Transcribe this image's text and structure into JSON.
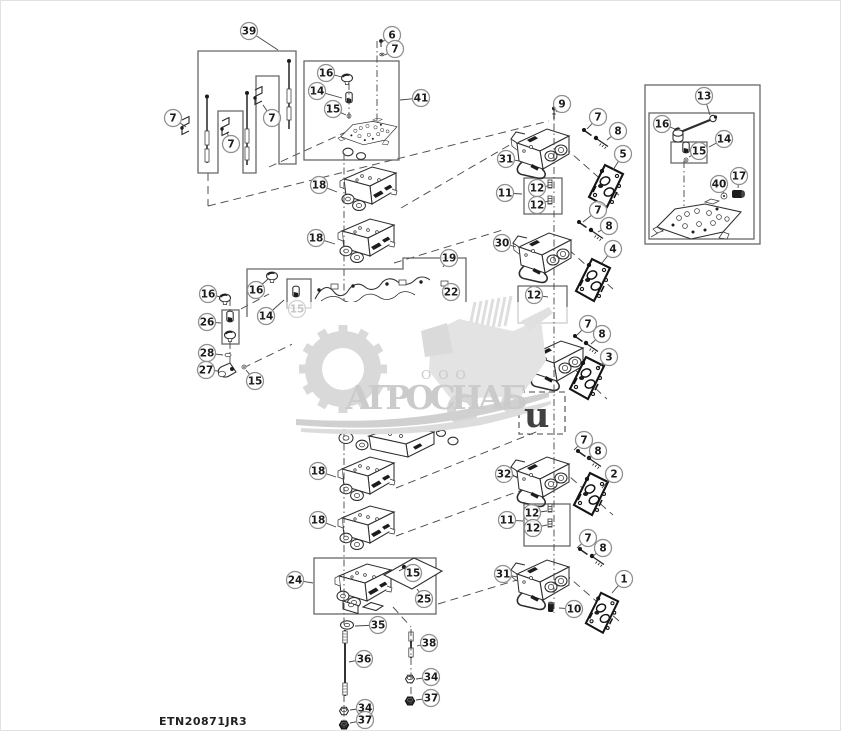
{
  "meta": {
    "footer_code": "ETN20871JR3"
  },
  "watermark": {
    "org": "ООО",
    "name": "АГРОСНАБ",
    "stray_letter": "u"
  },
  "colors": {
    "line": "#2d2d2d",
    "frame_box": "#686868",
    "dashed_line": "#4d4d4d",
    "balloon_stroke": "#8f8f8f",
    "balloon_text": "#1b1b1b",
    "watermark_gray": "#d6d6d6",
    "gasket_ink": "#141414"
  },
  "callouts": [
    {
      "n": "39",
      "x": 248,
      "y": 30,
      "lx": 277,
      "ly": 49
    },
    {
      "n": "7",
      "x": 172,
      "y": 117,
      "lx": 185,
      "ly": 126
    },
    {
      "n": "7",
      "x": 230,
      "y": 143,
      "lx": 226,
      "ly": 131
    },
    {
      "n": "7",
      "x": 271,
      "y": 117,
      "lx": 262,
      "ly": 104
    },
    {
      "n": "6",
      "x": 391,
      "y": 34,
      "lx": 381,
      "ly": 41
    },
    {
      "n": "7",
      "x": 394,
      "y": 48,
      "lx": 384,
      "ly": 54
    },
    {
      "n": "16",
      "x": 325,
      "y": 72,
      "lx": 341,
      "ly": 76
    },
    {
      "n": "14",
      "x": 316,
      "y": 90,
      "lx": 341,
      "ly": 97
    },
    {
      "n": "15",
      "x": 332,
      "y": 108,
      "lx": 345,
      "ly": 114
    },
    {
      "n": "41",
      "x": 420,
      "y": 97,
      "lx": 399,
      "ly": 99
    },
    {
      "n": "18",
      "x": 318,
      "y": 184,
      "lx": 336,
      "ly": 191
    },
    {
      "n": "18",
      "x": 315,
      "y": 237,
      "lx": 334,
      "ly": 243
    },
    {
      "n": "13",
      "x": 703,
      "y": 95,
      "lx": 709,
      "ly": 114
    },
    {
      "n": "16",
      "x": 661,
      "y": 123,
      "lx": 674,
      "ly": 128
    },
    {
      "n": "14",
      "x": 723,
      "y": 138,
      "lx": 708,
      "ly": 146
    },
    {
      "n": "15",
      "x": 698,
      "y": 150,
      "lx": 688,
      "ly": 156
    },
    {
      "n": "40",
      "x": 718,
      "y": 183,
      "lx": 723,
      "ly": 192
    },
    {
      "n": "17",
      "x": 738,
      "y": 175,
      "lx": 737,
      "ly": 187
    },
    {
      "n": "9",
      "x": 561,
      "y": 103,
      "lx": 555,
      "ly": 111
    },
    {
      "n": "7",
      "x": 597,
      "y": 116,
      "lx": 586,
      "ly": 128
    },
    {
      "n": "8",
      "x": 617,
      "y": 130,
      "lx": 606,
      "ly": 139
    },
    {
      "n": "31",
      "x": 505,
      "y": 158,
      "lx": 519,
      "ly": 160
    },
    {
      "n": "5",
      "x": 622,
      "y": 153,
      "lx": 612,
      "ly": 169
    },
    {
      "n": "11",
      "x": 504,
      "y": 192,
      "lx": 521,
      "ly": 193
    },
    {
      "n": "12",
      "x": 536,
      "y": 187,
      "lx": 547,
      "ly": 185
    },
    {
      "n": "12",
      "x": 536,
      "y": 204,
      "lx": 547,
      "ly": 200
    },
    {
      "n": "7",
      "x": 597,
      "y": 209,
      "lx": 582,
      "ly": 221
    },
    {
      "n": "8",
      "x": 608,
      "y": 225,
      "lx": 597,
      "ly": 231
    },
    {
      "n": "30",
      "x": 501,
      "y": 242,
      "lx": 515,
      "ly": 246
    },
    {
      "n": "4",
      "x": 612,
      "y": 248,
      "lx": 601,
      "ly": 262
    },
    {
      "n": "12",
      "x": 533,
      "y": 294,
      "lx": 547,
      "ly": 296
    },
    {
      "n": "7",
      "x": 587,
      "y": 323,
      "lx": 576,
      "ly": 334
    },
    {
      "n": "8",
      "x": 601,
      "y": 333,
      "lx": 590,
      "ly": 343
    },
    {
      "n": "3",
      "x": 608,
      "y": 356,
      "lx": 597,
      "ly": 367
    },
    {
      "n": "7",
      "x": 583,
      "y": 439,
      "lx": 573,
      "ly": 449
    },
    {
      "n": "8",
      "x": 597,
      "y": 450,
      "lx": 587,
      "ly": 458
    },
    {
      "n": "32",
      "x": 503,
      "y": 473,
      "lx": 517,
      "ly": 476
    },
    {
      "n": "2",
      "x": 613,
      "y": 473,
      "lx": 601,
      "ly": 487
    },
    {
      "n": "11",
      "x": 506,
      "y": 519,
      "lx": 522,
      "ly": 520
    },
    {
      "n": "12",
      "x": 531,
      "y": 512,
      "lx": 546,
      "ly": 510
    },
    {
      "n": "12",
      "x": 532,
      "y": 527,
      "lx": 546,
      "ly": 524
    },
    {
      "n": "7",
      "x": 587,
      "y": 537,
      "lx": 576,
      "ly": 547
    },
    {
      "n": "8",
      "x": 602,
      "y": 547,
      "lx": 592,
      "ly": 555
    },
    {
      "n": "31",
      "x": 502,
      "y": 573,
      "lx": 516,
      "ly": 576
    },
    {
      "n": "1",
      "x": 623,
      "y": 578,
      "lx": 611,
      "ly": 592
    },
    {
      "n": "10",
      "x": 573,
      "y": 608,
      "lx": 558,
      "ly": 607
    },
    {
      "n": "16",
      "x": 207,
      "y": 293,
      "lx": 220,
      "ly": 296
    },
    {
      "n": "26",
      "x": 206,
      "y": 321,
      "lx": 220,
      "ly": 322
    },
    {
      "n": "28",
      "x": 206,
      "y": 352,
      "lx": 222,
      "ly": 354
    },
    {
      "n": "27",
      "x": 205,
      "y": 369,
      "lx": 218,
      "ly": 370
    },
    {
      "n": "15",
      "x": 254,
      "y": 380,
      "lx": 245,
      "ly": 369
    },
    {
      "n": "16",
      "x": 255,
      "y": 289,
      "lx": 267,
      "ly": 278
    },
    {
      "n": "14",
      "x": 265,
      "y": 315,
      "lx": 283,
      "ly": 299
    },
    {
      "n": "15",
      "x": 296,
      "y": 308,
      "faded": true
    },
    {
      "n": "19",
      "x": 448,
      "y": 257,
      "lx": 442,
      "ly": 266
    },
    {
      "n": "22",
      "x": 450,
      "y": 291
    },
    {
      "n": "18",
      "x": 317,
      "y": 470,
      "lx": 335,
      "ly": 476
    },
    {
      "n": "18",
      "x": 317,
      "y": 519,
      "lx": 335,
      "ly": 526
    },
    {
      "n": "24",
      "x": 294,
      "y": 579,
      "lx": 312,
      "ly": 582
    },
    {
      "n": "15",
      "x": 412,
      "y": 572
    },
    {
      "n": "25",
      "x": 423,
      "y": 598,
      "lx": 416,
      "ly": 588
    },
    {
      "n": "35",
      "x": 377,
      "y": 624,
      "lx": 354,
      "ly": 625
    },
    {
      "n": "36",
      "x": 363,
      "y": 658,
      "lx": 348,
      "ly": 661
    },
    {
      "n": "38",
      "x": 428,
      "y": 642,
      "lx": 416,
      "ly": 645
    },
    {
      "n": "34",
      "x": 430,
      "y": 676,
      "lx": 415,
      "ly": 678
    },
    {
      "n": "37",
      "x": 430,
      "y": 697,
      "lx": 415,
      "ly": 699
    },
    {
      "n": "34",
      "x": 364,
      "y": 707,
      "lx": 349,
      "ly": 709
    },
    {
      "n": "37",
      "x": 364,
      "y": 719,
      "lx": 349,
      "ly": 722
    }
  ]
}
